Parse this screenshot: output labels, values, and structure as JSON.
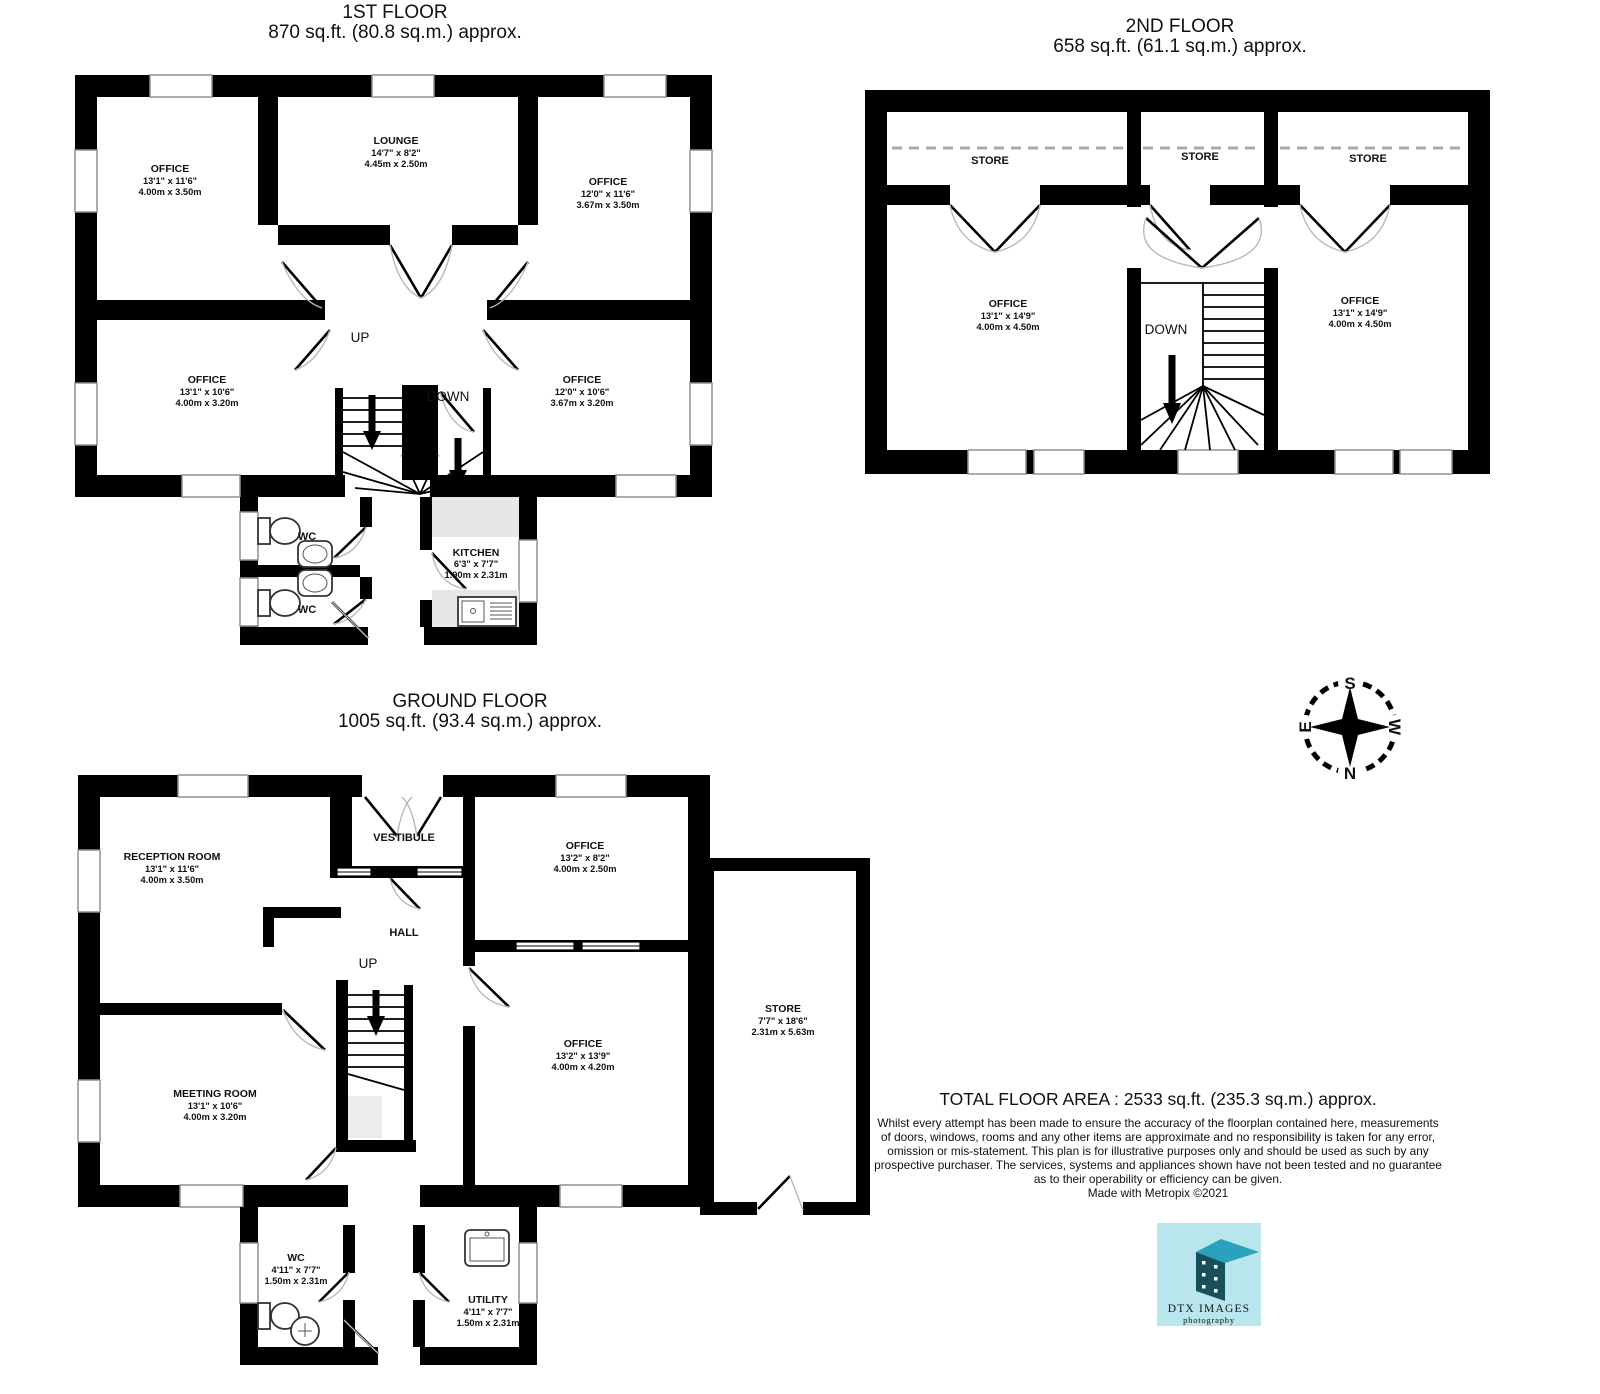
{
  "first": {
    "title": "1ST FLOOR",
    "area": "870 sq.ft. (80.8 sq.m.) approx.",
    "office_tl": {
      "name": "OFFICE",
      "imperial": "13'1\" x 11'6\"",
      "metric": "4.00m x 3.50m"
    },
    "lounge": {
      "name": "LOUNGE",
      "imperial": "14'7\" x 8'2\"",
      "metric": "4.45m x 2.50m"
    },
    "office_tr": {
      "name": "OFFICE",
      "imperial": "12'0\" x 11'6\"",
      "metric": "3.67m x 3.50m"
    },
    "office_bl": {
      "name": "OFFICE",
      "imperial": "13'1\" x 10'6\"",
      "metric": "4.00m x 3.20m"
    },
    "office_br": {
      "name": "OFFICE",
      "imperial": "12'0\" x 10'6\"",
      "metric": "3.67m x 3.20m"
    },
    "kitchen": {
      "name": "KITCHEN",
      "imperial": "6'3\" x 7'7\"",
      "metric": "1.90m x 2.31m"
    },
    "wc1": "WC",
    "wc2": "WC",
    "up": "UP",
    "down": "DOWN"
  },
  "second": {
    "title": "2ND FLOOR",
    "area": "658 sq.ft. (61.1 sq.m.) approx.",
    "store1": "STORE",
    "store2": "STORE",
    "store3": "STORE",
    "office_l": {
      "name": "OFFICE",
      "imperial": "13'1\" x 14'9\"",
      "metric": "4.00m x 4.50m"
    },
    "office_r": {
      "name": "OFFICE",
      "imperial": "13'1\" x 14'9\"",
      "metric": "4.00m x 4.50m"
    },
    "down": "DOWN"
  },
  "ground": {
    "title": "GROUND FLOOR",
    "area": "1005 sq.ft. (93.4 sq.m.) approx.",
    "reception": {
      "name": "RECEPTION ROOM",
      "imperial": "13'1\" x 11'6\"",
      "metric": "4.00m x 3.50m"
    },
    "office_t": {
      "name": "OFFICE",
      "imperial": "13'2\" x 8'2\"",
      "metric": "4.00m x 2.50m"
    },
    "meeting": {
      "name": "MEETING ROOM",
      "imperial": "13'1\" x 10'6\"",
      "metric": "4.00m x 3.20m"
    },
    "office_b": {
      "name": "OFFICE",
      "imperial": "13'2\" x 13'9\"",
      "metric": "4.00m x 4.20m"
    },
    "store": {
      "name": "STORE",
      "imperial": "7'7\" x 18'6\"",
      "metric": "2.31m x 5.63m"
    },
    "wc": {
      "name": "WC",
      "imperial": "4'11\" x 7'7\"",
      "metric": "1.50m x 2.31m"
    },
    "utility": {
      "name": "UTILITY",
      "imperial": "4'11\" x 7'7\"",
      "metric": "1.50m x 2.31m"
    },
    "vestibule": "VESTIBULE",
    "hall": "HALL",
    "up": "UP"
  },
  "summary": {
    "total": "TOTAL FLOOR AREA : 2533 sq.ft. (235.3 sq.m.) approx.",
    "line1": "Whilst every attempt has been made to ensure the accuracy of the floorplan contained here, measurements",
    "line2": "of doors, windows, rooms and any other items are approximate and no responsibility is taken for any error,",
    "line3": "omission or mis-statement. This plan is for illustrative purposes only and should be used as such by any",
    "line4": "prospective purchaser. The services, systems and appliances shown have not been tested and no guarantee",
    "line5": "as to their operability or efficiency can be given.",
    "credit": "Made with Metropix ©2021"
  },
  "compass": {
    "n": "N",
    "s": "S",
    "e": "E",
    "w": "W"
  },
  "logo": {
    "title": "DTX IMAGES",
    "subtitle": "photography",
    "bg": "#b9e5ec",
    "roof": "#2aa2bd",
    "front": "#174f5b",
    "text": "#1c3040",
    "subtext": "#2e5561"
  }
}
